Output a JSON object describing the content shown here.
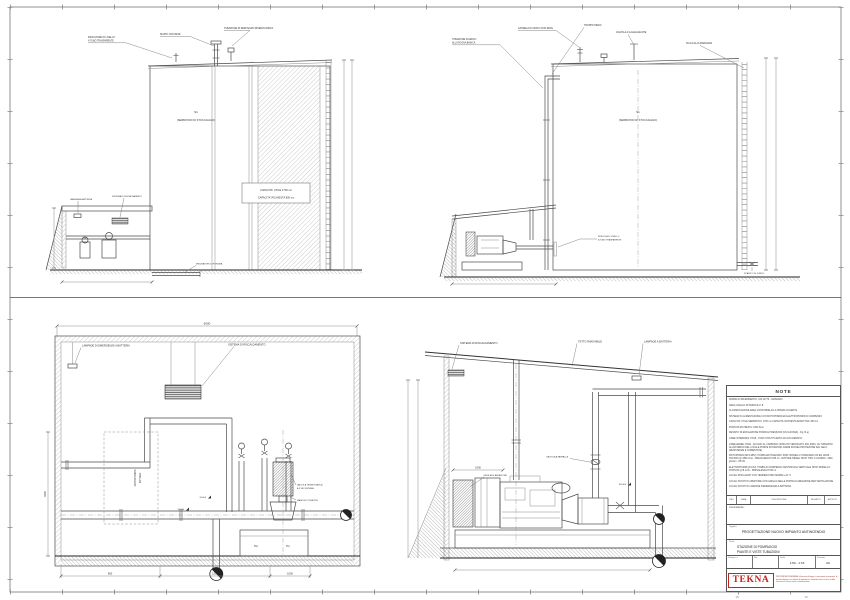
{
  "frame": {
    "ref_a": "15",
    "ref_b": "16"
  },
  "views": {
    "elevLeft": {
      "callout_level_1": "INDICATORE DI LIVELLO",
      "callout_level_2": "A TUBO TRASPARENTE",
      "callout_vent": "SFIATO CON RETE",
      "callout_refill": "TUBAZIONE DI REINTEGRO RISERVA IDRICA",
      "tank_code": "S1",
      "tank_name": "(SERBATOIO DI STOCCAGGIO)",
      "capacity_line1": "CAPACITA' UTILE 1700 mc",
      "capacity_line2": "CAPACITA' RICHIESTA 800 mc",
      "callout_lamp": "LAMPADA A BATTERIA",
      "callout_heater": "SISTEMA DI RISCALDAMENTO",
      "flow_meter": "MISURATORE DI PORTATA"
    },
    "elevRight": {
      "callout_drain_1": "TUBAZIONE SCARICO",
      "callout_drain_2": "ALLA FOGNA BIANCA",
      "callout_vent": "CANDELA DI SFIATO CON RETE",
      "callout_overflow": "TROPPO PIENO",
      "callout_float": "VALVOLA A GALLEGGIANTE",
      "callout_ladder": "SCALA ALLA MARINARA",
      "tank_code": "S1",
      "tank_name": "(SERBATOIO DI STOCCAGGIO)",
      "callout_gauge_1": "SPECOLA DI LIVELLO",
      "callout_gauge_2": "A TUBO TRASPARENTE",
      "callout_drain_bottom": "SCARICO DI FONDO"
    },
    "sectLeft": {
      "dim_width": "6000",
      "callout_lamps": "LAMPADE DI EMERGENZA A BATTERIA",
      "callout_heating": "SISTEMA DI RISCALDAMENTO",
      "future_pump_line1": "MOTOPOMPA",
      "future_pump_line2": "FUTURA",
      "valve_label_1": "VALVOLA TERMOSTATICA",
      "valve_label_2": "A 3 VIE SISTEMA",
      "gauge_label": "MANOVUOTOMETRO",
      "level_a": "90.600",
      "level_b": "90.000",
      "pump_p2": "P2",
      "pump_p1": "P1",
      "dim_a": "950",
      "dim_b": "1250",
      "dim_c": "1000",
      "dim_height": "3400"
    },
    "sectRight": {
      "callout_heating": "SISTEMA DI RISCALDAMENTO",
      "callout_roof": "TETTO RIMOVIBILE",
      "callout_lamps": "LAMPADE A BATTERIA",
      "dim_grille": "1000",
      "grille_label": "GRIGLIA DI AERAZIONE",
      "valve_label": "VALVOLA A FARFALLA",
      "level_a": "100.300"
    }
  },
  "notes": {
    "title": "NOTE",
    "lines": [
      "NORMA DI RIFERIMENTO: UNI 10779 - 04/09/2010",
      "AREA LIVELLO DI PERICOLO: B",
      "CLASSIFICAZIONE AREA CONFORME ALLA NORMA COGENTE",
      "SISTEMA DI ALIMENTAZIONE CON MOTOPOMPA ED ELETTROPOMPA DI COMPENSO",
      "CAPACITA' UTILE SERBATOIO: 1700 mc      CAPACITA' RICHIESTA EFFETTIVA: 800 mc",
      "PORTATA RICHIESTA: 1800 l/min",
      "DENSITA' DI EROGAZIONE POMPA E PRESSIONI (UNI 120 BAR) - Fig. B a)",
      "LINEE INTERRATE:  PN16 - TUBO STRUTTURATO AD ALTA DENSITA'",
      "LINEE AEREE:  PN16 - ACCIAIO AL CARBONIO (ZINCATO VERNICIATO RAL 3000). LE TUBAZIONI ALL'ESTERNO DEL LOCALE POMPE DOVRANNO AVERE IDONEA PROTEZIONE DAL GELO (RESISTENZE E COIBENTATE)",
      "MOTOPOMPA (MP1-MP2):  POMPA ANTINCENDIO 'MOD' MODELLO STANDARD UNI EN 12845 - TESTATA Q=1800 l/min - PREVALENZA H=85 mt - MOTORE DIESEL 'MOD' TIPO 4 CILINDRI - 2900 giri/min - 85 kW",
      "ELETTROPOMPA (P1-P2):  POMPA DI COMPENSO CENTRIFUGA VERTICALE 'MOD' MODELLO: PORTATA Q=8 mc/h - PREVALENZA H=95 mt",
      "LOCALI RISCALDATI CON TEMPERATURA MINIMA +10 °C",
      "LOCALI DOTATI DI APERTURE CON GRIGLIA NELLE PORTE DI AREAZIONE PER VENTILAZIONE",
      "LOCALI DOTATI DI LAMPADE D'EMERGENZA A BATTERIA"
    ]
  },
  "revisions": {
    "headers": [
      "REV",
      "DATA",
      "DESCRIZIONE",
      "REDATTO",
      "APPROV."
    ]
  },
  "title_block": {
    "client_label": "Committente:",
    "subject_label": "Oggetto:",
    "subject": "PROGETTAZIONE NUOVO IMPIANTO ANTINCENDIO",
    "title_label": "Titolo:",
    "title_line1": "STAZIONE DI POMPAGGIO",
    "title_line2": "PIANTE E VISTE TUBAZIONI",
    "drawing_no_label": "Disegno n.",
    "file_label": "File",
    "scale_label": "Scala",
    "scale_value": "1:50 - 1:15",
    "format_label": "Formato",
    "format_value": "A0",
    "logo": "TEKNA",
    "disclaimer": "PROPRIETA' RISERVATA - A termini di legge ci riserviamo la proprieta' di questo disegno con divieto di riprodurlo o renderlo noto a terzi o a ditte concorrenti senza nostra autorizzazione."
  }
}
